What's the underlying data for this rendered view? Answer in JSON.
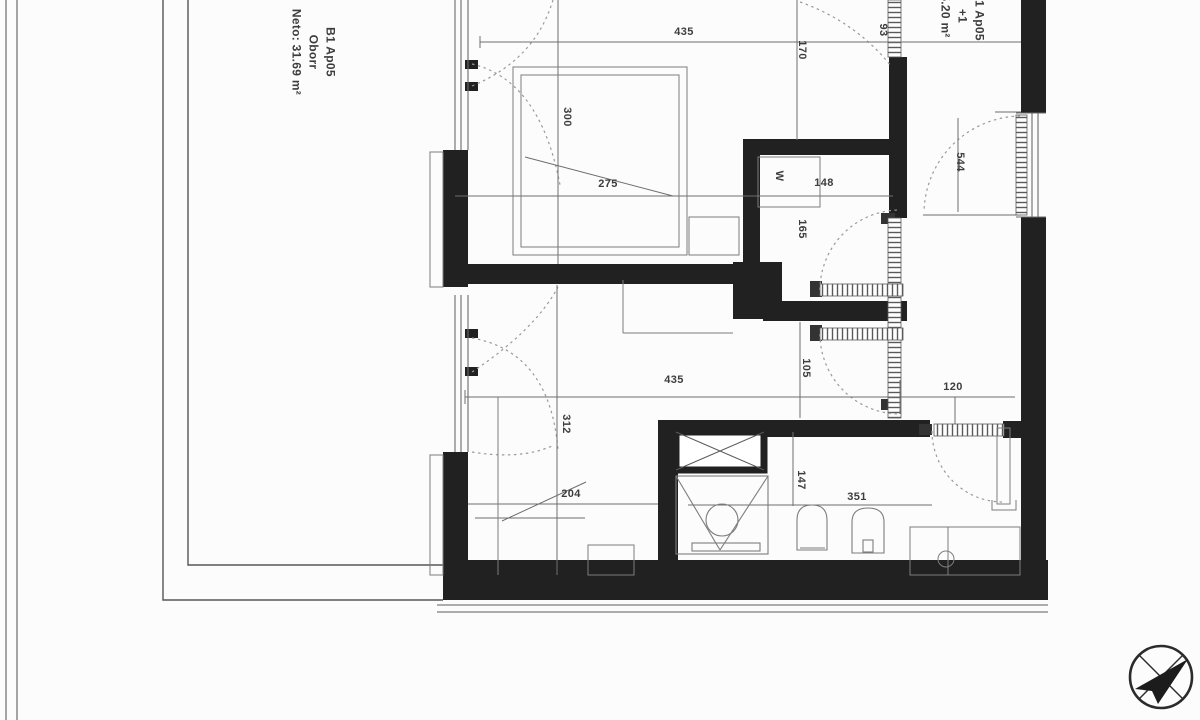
{
  "plan": {
    "unit_label": {
      "line1": "B1 Ap05",
      "line2": "Oborr",
      "line3": "Neto: 31.69 m²"
    },
    "terrace_label": {
      "line1": "B1 Ap05",
      "line2": "+1",
      "line3": "5.20 m²"
    },
    "dimensions": {
      "top_width": "435",
      "entry_depth": "170",
      "entry_door_width": "93",
      "bed_length": "300",
      "bed_width": "275",
      "wardrobe_letter": "W",
      "wardrobe_width": "148",
      "wardrobe_depth": "165",
      "right_room_opening": "544",
      "hall_width": "105",
      "mid_width": "435",
      "bath_door_width": "120",
      "room2_depth": "312",
      "room2_width": "204",
      "bath_depth": "147",
      "bath_width": "351"
    },
    "icons": {
      "compass": "north-arrow-compass"
    }
  }
}
